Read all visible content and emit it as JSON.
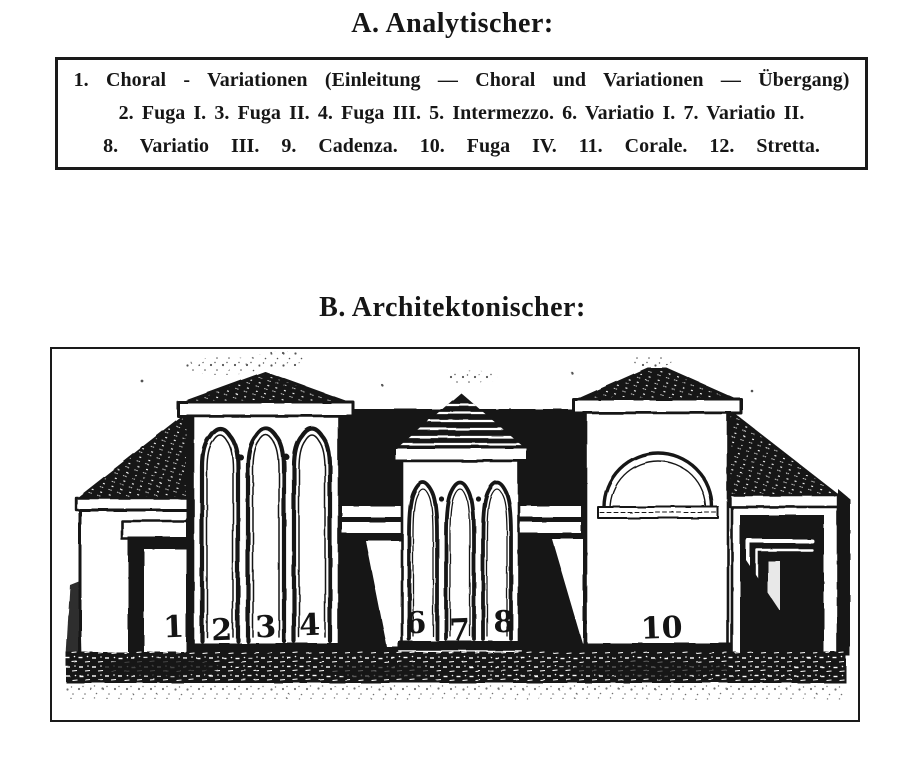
{
  "page": {
    "paper_color": "#ffffff",
    "ink_color": "#1b1b1b"
  },
  "section_a": {
    "title": "A. Analytischer:",
    "lines": [
      "1. Choral - Variationen (Einleitung — Choral und Variationen — Übergang)",
      "2. Fuga I. 3. Fuga II. 4. Fuga III. 5. Intermezzo. 6. Variatio I. 7. Variatio II.",
      "8. Variatio III. 9. Cadenza. 10. Fuga IV. 11. Corale. 12. Stretta."
    ]
  },
  "section_b": {
    "title": "B. Architektonischer:",
    "figure": {
      "type": "architectural-sketch",
      "labels": [
        {
          "text": "1",
          "x": 122,
          "y": 288
        },
        {
          "text": "2",
          "x": 170,
          "y": 291
        },
        {
          "text": "3",
          "x": 214,
          "y": 288
        },
        {
          "text": "4",
          "x": 258,
          "y": 286
        },
        {
          "text": "6",
          "x": 364,
          "y": 284
        },
        {
          "text": "7",
          "x": 408,
          "y": 291
        },
        {
          "text": "8",
          "x": 452,
          "y": 283
        },
        {
          "text": "10",
          "x": 610,
          "y": 289
        }
      ]
    }
  }
}
